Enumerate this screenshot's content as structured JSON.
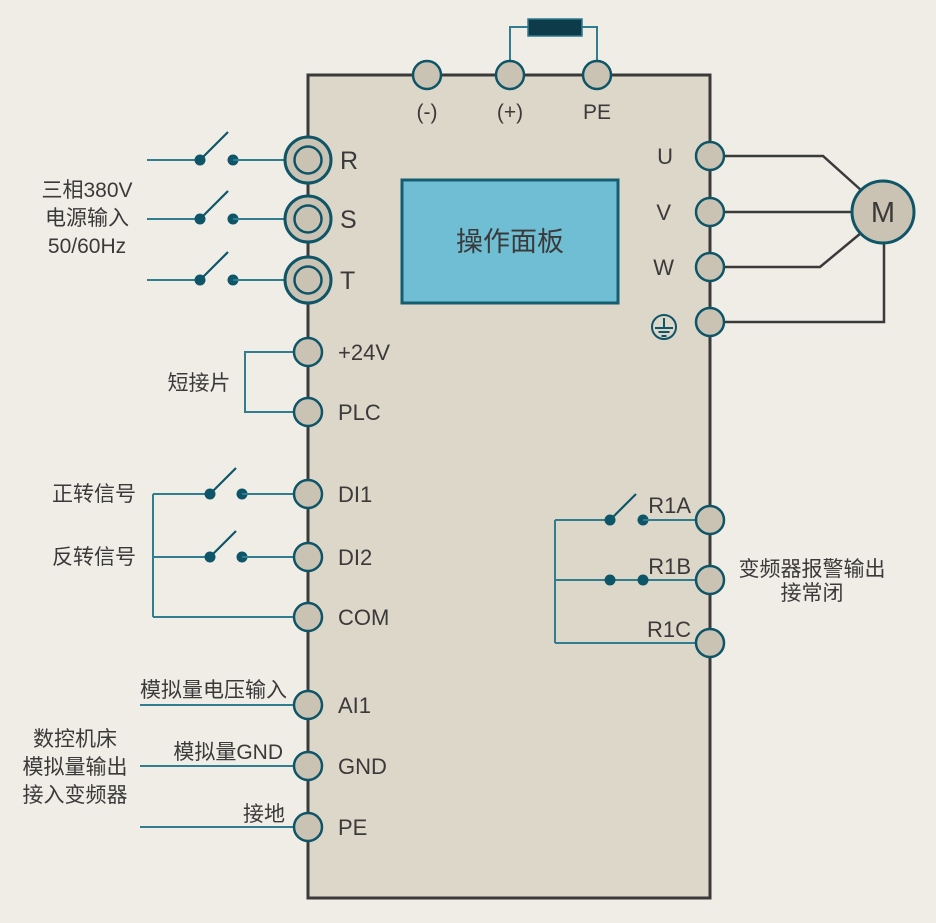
{
  "colors": {
    "background": "#f0ede6",
    "inverter_fill": "#ddd7ca",
    "outline_dark": "#3a3a3a",
    "wire_teal": "#2f7d8e",
    "teal_dark": "#0e5568",
    "terminal_fill": "#cac3b3",
    "terminal_border": "#0e5568",
    "panel_fill": "#70bed3",
    "panel_border": "#155e70",
    "resistor_fill": "#0d3b4a",
    "text": "#3a3a3a"
  },
  "top_terminals": {
    "minus_label": "(-)",
    "plus_label": "(+)",
    "pe_label": "PE"
  },
  "power_input": {
    "label_lines": [
      "三相380V",
      "电源输入",
      "50/60Hz"
    ],
    "terminal_r": "R",
    "terminal_s": "S",
    "terminal_t": "T"
  },
  "panel": {
    "label": "操作面板"
  },
  "motor": {
    "label": "M"
  },
  "output_terminals": {
    "u": "U",
    "v": "V",
    "w": "W"
  },
  "control_terminals": {
    "v24": "+24V",
    "plc": "PLC",
    "di1": "DI1",
    "di2": "DI2",
    "com": "COM",
    "jumper_label": "短接片",
    "forward_label": "正转信号",
    "reverse_label": "反转信号"
  },
  "analog_terminals": {
    "ai1": "AI1",
    "gnd": "GND",
    "pe": "PE",
    "ai1_line_label": "模拟量电压输入",
    "gnd_line_label": "模拟量GND",
    "pe_line_label": "接地",
    "source_label_lines": [
      "数控机床",
      "模拟量输出",
      "接入变频器"
    ]
  },
  "relay": {
    "r1a": "R1A",
    "r1b": "R1B",
    "r1c": "R1C",
    "label_lines": [
      "变频器报警输出",
      "接常闭"
    ]
  }
}
